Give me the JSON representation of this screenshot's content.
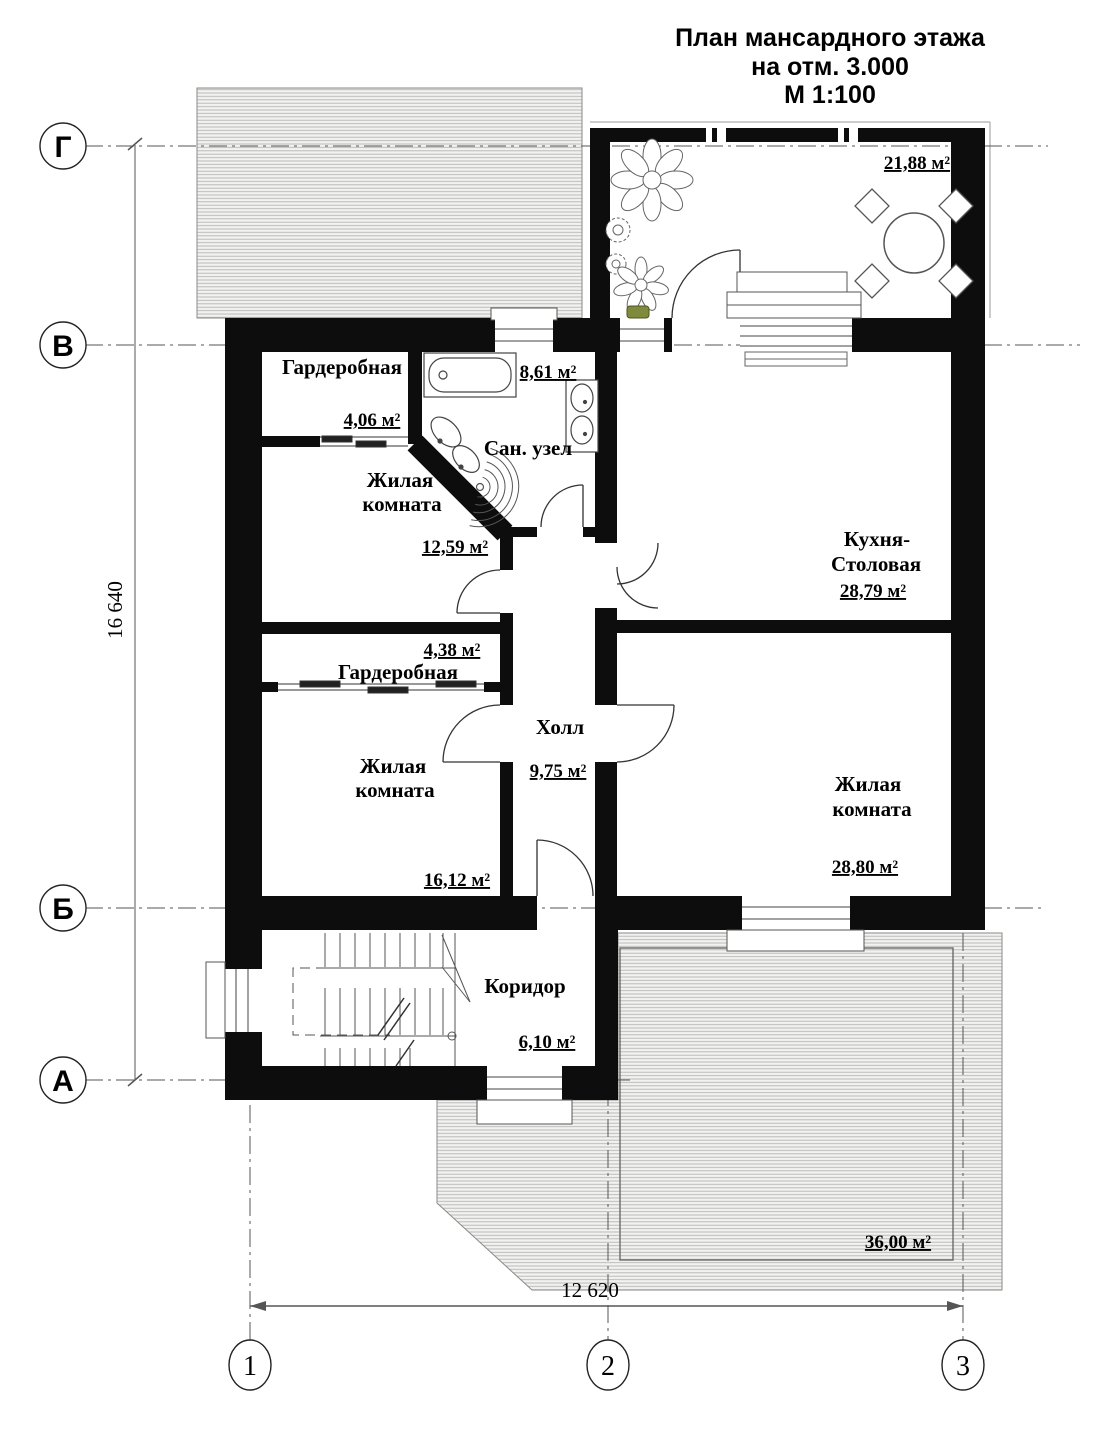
{
  "title": {
    "lines": [
      "План мансардного этажа",
      "на отм. 3.000",
      "М 1:100"
    ]
  },
  "axes": {
    "rows": [
      "Г",
      "В",
      "Б",
      "А"
    ],
    "cols": [
      "1",
      "2",
      "3"
    ]
  },
  "dimensions": {
    "height_total": "16 640",
    "width_total": "12 620"
  },
  "rooms": [
    {
      "lines": [
        "Гардеробная"
      ],
      "area": "4,06 м²"
    },
    {
      "lines": [
        "Сан. узел"
      ],
      "area": "8,61 м²"
    },
    {
      "lines": [
        "Жилая",
        "комната"
      ],
      "area": "12,59 м²"
    },
    {
      "lines": [
        "Кухня-",
        "Столовая"
      ],
      "area": "28,79 м²"
    },
    {
      "lines": [
        "Гардеробная"
      ],
      "area": "4,38 м²"
    },
    {
      "lines": [
        "Холл"
      ],
      "area": "9,75 м²"
    },
    {
      "lines": [
        "Жилая",
        "комната"
      ],
      "area": "16,12 м²"
    },
    {
      "lines": [
        "Жилая",
        "комната"
      ],
      "area": "28,80 м²"
    },
    {
      "lines": [
        "Коридор"
      ],
      "area": "6,10 м²"
    },
    {
      "area": "21,88 м²"
    },
    {
      "area": "36,00 м²"
    }
  ],
  "colors": {
    "wall": "#0d0d0d",
    "hatch_line": "#b5b5b3",
    "hatch_bg": "#f2f2f0",
    "axis_line": "#555555",
    "thin_line": "#444444",
    "plant_pot": "#7f8a3c"
  }
}
